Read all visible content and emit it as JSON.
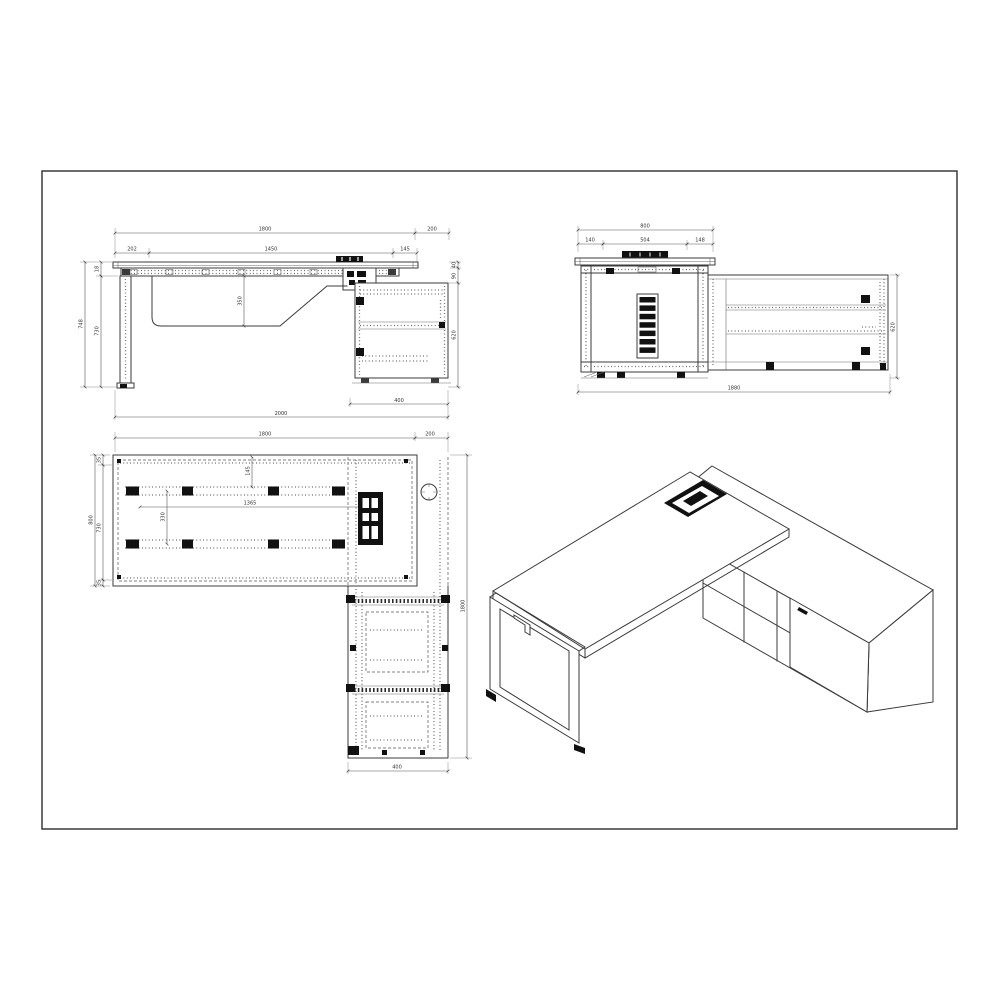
{
  "colors": {
    "line": "#3b3b3b",
    "dimension": "#555555",
    "fill_black": "#111111",
    "background": "#ffffff"
  },
  "front": {
    "overall_width": "1800",
    "overhang": "200",
    "left_offset": "202",
    "rail_span": "1450",
    "grommet_offset": "145",
    "total_height": "748",
    "leg_height": "730",
    "top_thickness": "18",
    "tray_depth": "350",
    "top_gap": "40",
    "apron_gap": "90",
    "cabinet_height": "620",
    "cabinet_width": "400",
    "overall_length": "2000"
  },
  "end": {
    "overall_depth": "800",
    "front_inset": "140",
    "frame_span": "504",
    "back_inset": "148",
    "cabinet_height": "620",
    "cabinet_length": "1880"
  },
  "plan": {
    "desk_width": "1800",
    "overhang": "200",
    "desk_depth": "800",
    "inner_depth": "730",
    "edge_inset_top": "35",
    "edge_inset_bottom": "35",
    "rail_length": "1365",
    "rail_spacing": "330",
    "edge_to_rail": "145",
    "run_length": "1800",
    "cabinet_width": "400"
  }
}
